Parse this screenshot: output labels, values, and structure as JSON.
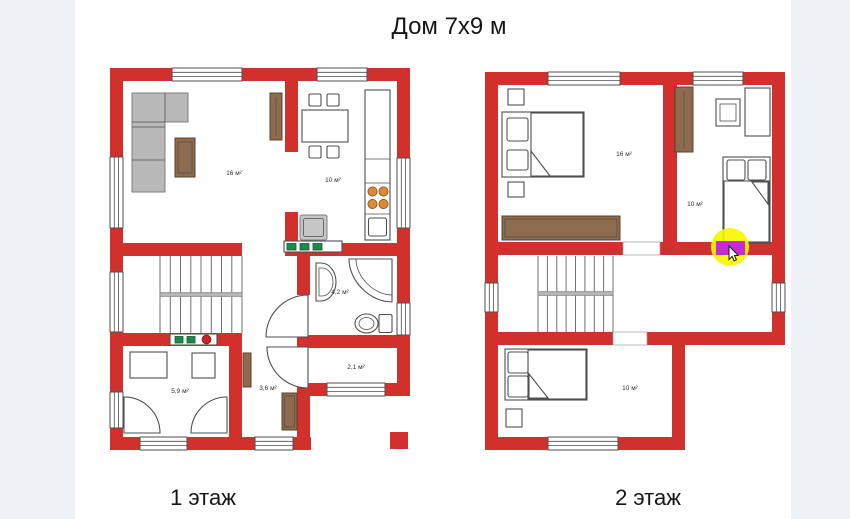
{
  "page": {
    "title": "Дом 7x9 м",
    "background_color": "#edf0f4",
    "canvas_color": "#ffffff"
  },
  "floors": [
    {
      "caption": "1 этаж",
      "rooms": [
        {
          "name": "living-room",
          "area_label": "16 м²"
        },
        {
          "name": "kitchen",
          "area_label": "10 м²"
        },
        {
          "name": "bathroom",
          "area_label": "4,2 м²"
        },
        {
          "name": "entry",
          "area_label": "2,1 м²"
        },
        {
          "name": "utility-room",
          "area_label": "5,9 м²"
        },
        {
          "name": "hallway",
          "area_label": "3,6 м²"
        }
      ]
    },
    {
      "caption": "2 этаж",
      "rooms": [
        {
          "name": "bedroom-master",
          "area_label": "16 м²"
        },
        {
          "name": "bedroom-right",
          "area_label": "10 м²"
        },
        {
          "name": "bedroom-lower",
          "area_label": "10 м²"
        }
      ]
    }
  ],
  "colors": {
    "page_bg": "#edf0f4",
    "wall_red": "#d2302c",
    "sofa_gray": "#b9b9b9",
    "appliance_gray": "#c6c6c6",
    "wood_brown": "#8f6b4e",
    "radiator_green": "#1d8a4b",
    "indicator_red": "#cc2424",
    "burner_orange": "#dd8a36",
    "highlight_yellow": "#f7f502",
    "highlight_magenta": "#c42bd4",
    "outline_dark": "#4f4f4f"
  }
}
